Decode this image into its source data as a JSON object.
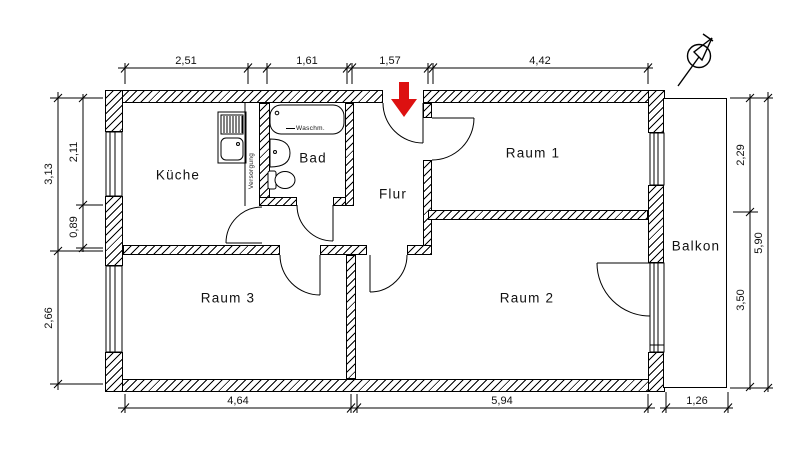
{
  "drawing": {
    "type": "apartment-floor-plan",
    "units": "meters-comma-decimal"
  },
  "rooms": {
    "kueche": {
      "label": "Küche"
    },
    "bad": {
      "label": "Bad"
    },
    "flur": {
      "label": "Flur"
    },
    "raum1": {
      "label": "Raum 1"
    },
    "raum2": {
      "label": "Raum 2"
    },
    "raum3": {
      "label": "Raum 3"
    },
    "balkon": {
      "label": "Balkon"
    }
  },
  "annotations": {
    "washing_machine": "Waschm.",
    "utility_shaft": "Versorgung"
  },
  "dimensions": {
    "top": [
      "2,51",
      "1,61",
      "1,57",
      "4,42"
    ],
    "bottom": [
      "4,64",
      "5,94",
      "1,26"
    ],
    "left_outer": [
      "3,13",
      "2,66"
    ],
    "left_inner": [
      "2,11",
      "0,89"
    ],
    "right_inner": [
      "2,29",
      "3,50"
    ],
    "right_outer": [
      "5,90"
    ]
  },
  "symbols": {
    "north_arrow": "north-arrow",
    "entrance_arrow": "entrance-direction-arrow"
  },
  "colors": {
    "entrance_arrow": "#dd1111",
    "lines": "#000000",
    "background": "#ffffff"
  }
}
